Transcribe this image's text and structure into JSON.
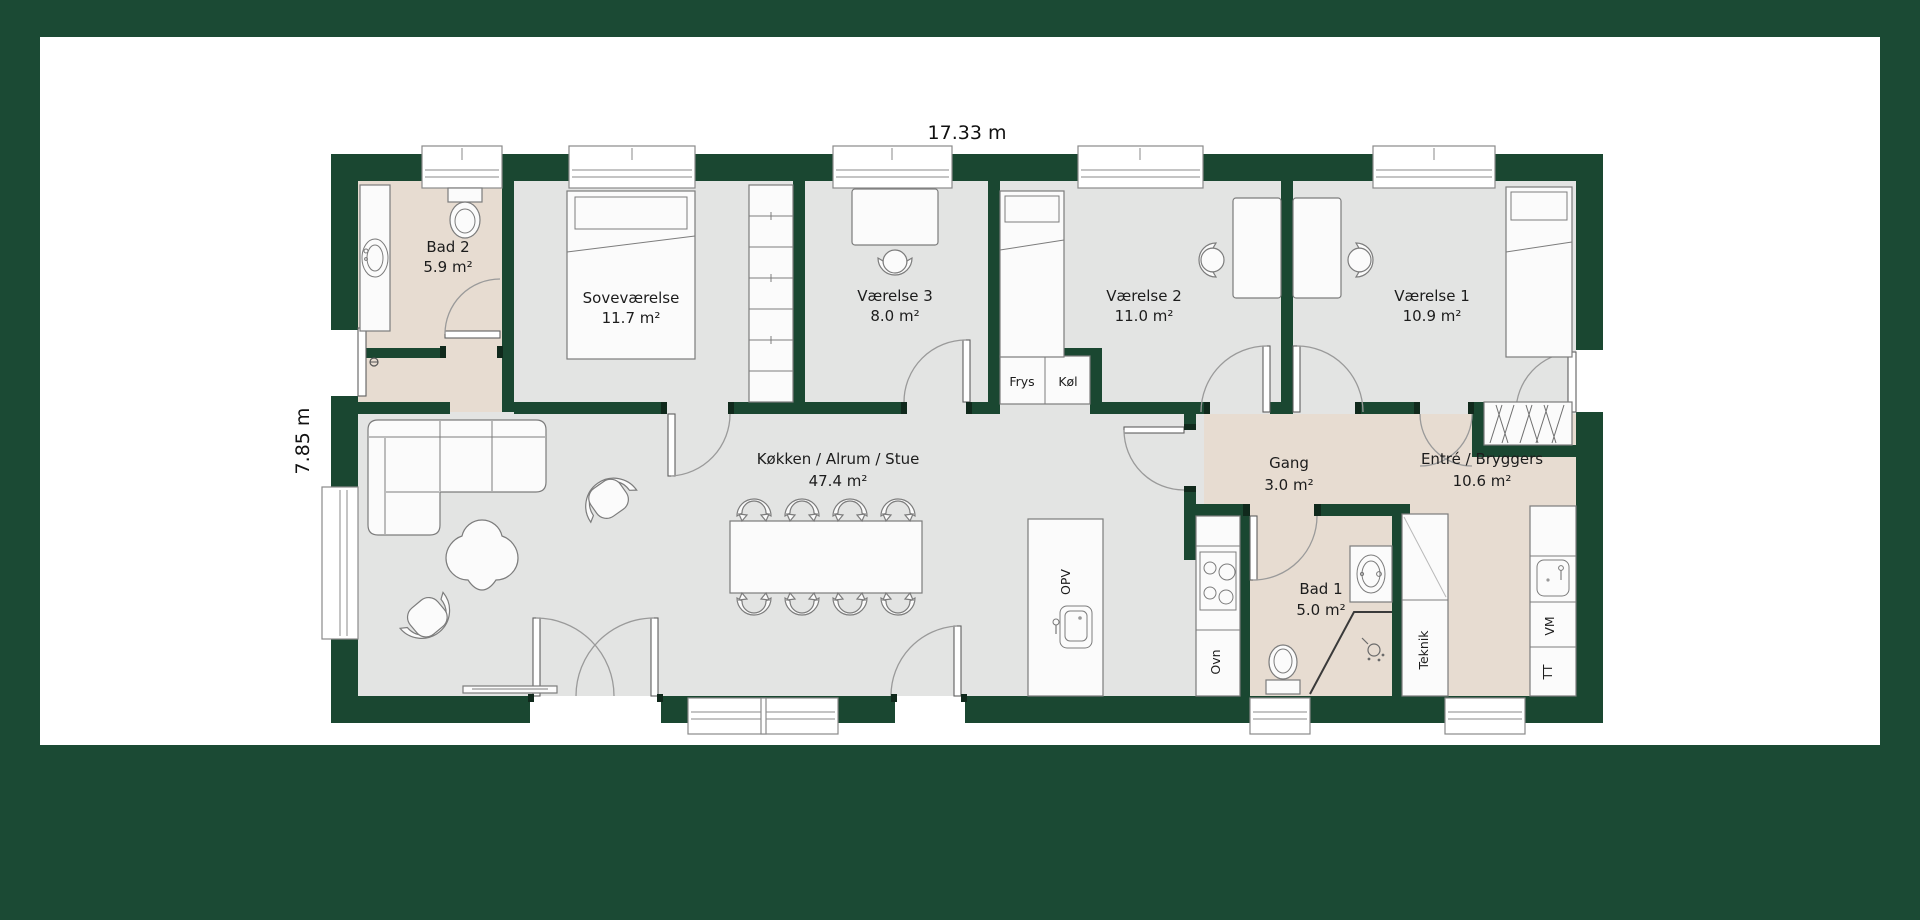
{
  "colors": {
    "frame_green": "#1b4a34",
    "wall_green": "#1a4731",
    "floor_gray": "#e3e4e3",
    "floor_wet_beige": "#e7dcd1",
    "canvas_white": "#ffffff"
  },
  "dimensions": {
    "width": "17.33 m",
    "height": "7.85 m"
  },
  "rooms": [
    {
      "id": "bad2",
      "name": "Bad 2",
      "area": "5.9 m²"
    },
    {
      "id": "sovevaerelse",
      "name": "Soveværelse",
      "area": "11.7 m²"
    },
    {
      "id": "vaerelse3",
      "name": "Værelse 3",
      "area": "8.0 m²"
    },
    {
      "id": "vaerelse2",
      "name": "Værelse 2",
      "area": "11.0 m²"
    },
    {
      "id": "vaerelse1",
      "name": "Værelse 1",
      "area": "10.9 m²"
    },
    {
      "id": "koekken",
      "name": "Køkken / Alrum / Stue",
      "area": "47.4 m²"
    },
    {
      "id": "gang",
      "name": "Gang",
      "area": "3.0 m²"
    },
    {
      "id": "bad1",
      "name": "Bad 1",
      "area": "5.0 m²"
    },
    {
      "id": "entre",
      "name": "Entré / Bryggers",
      "area": "10.6 m²"
    }
  ],
  "fixtures": {
    "frys": "Frys",
    "koel": "Køl",
    "opv": "OPV",
    "ovn": "Ovn",
    "teknik": "Teknik",
    "vm": "VM",
    "tt": "TT"
  }
}
